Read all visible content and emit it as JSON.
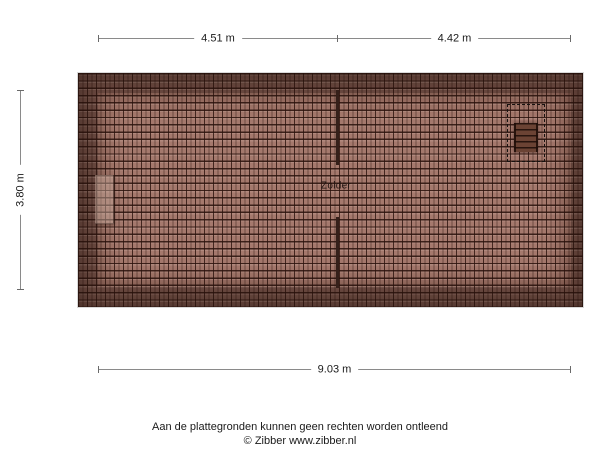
{
  "dimensions": {
    "top_left": "4.51 m",
    "top_right": "4.42 m",
    "left": "3.80 m",
    "bottom": "9.03 m"
  },
  "plan": {
    "room_label": "Zolder",
    "icons": {
      "loft_ladder": "loft-ladder-icon (rails with rungs)",
      "roof_hatch": "dashed-rectangle-outline",
      "chimney": "chimney-block"
    },
    "colors": {
      "tile_inner": "#a5796d",
      "tile_border_band": "#6b4a41",
      "tile_line": "#2a120c",
      "interior_wall": "#35201a",
      "dimension_line": "#8a8a8a",
      "text": "#1a1a1a"
    }
  },
  "footer": {
    "disclaimer": "Aan de plattegronden kunnen geen rechten worden ontleend",
    "credit": "© Zibber www.zibber.nl"
  }
}
